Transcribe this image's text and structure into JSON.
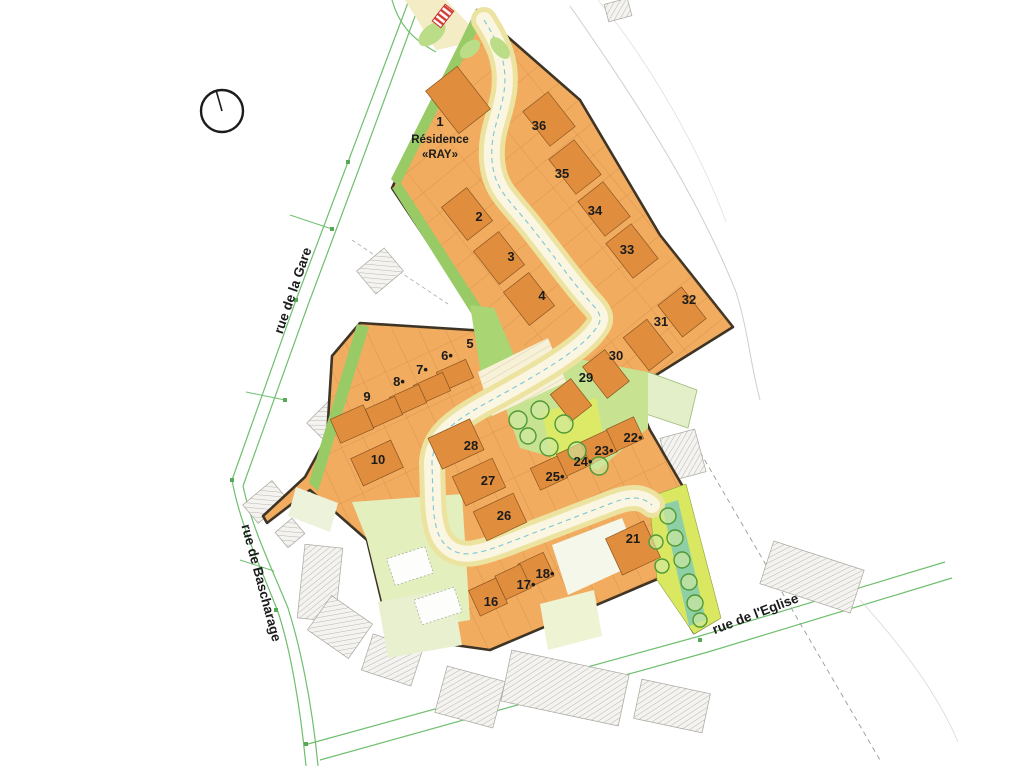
{
  "page": {
    "width": 1024,
    "height": 768,
    "background": "#ffffff",
    "title": "Plan de lotissement - Résidence «RAY»"
  },
  "plan": {
    "residence": {
      "lot_number": "1",
      "line1": "Résidence",
      "line2": "«RAY»",
      "x": 440,
      "y1": 126,
      "y2": 143,
      "y3": 158
    },
    "streets": [
      {
        "label": "rue de la Gare",
        "x": 297,
        "y": 292,
        "rot": -71
      },
      {
        "label": "rue de Bascharage",
        "x": 257,
        "y": 584,
        "rot": 75
      },
      {
        "label": "rue de l'Eglise",
        "x": 757,
        "y": 618,
        "rot": -21
      }
    ],
    "lots": [
      {
        "n": "2",
        "x": 479,
        "y": 221
      },
      {
        "n": "3",
        "x": 511,
        "y": 261
      },
      {
        "n": "4",
        "x": 542,
        "y": 300
      },
      {
        "n": "5",
        "x": 470,
        "y": 348
      },
      {
        "n": "6•",
        "x": 447,
        "y": 360
      },
      {
        "n": "7•",
        "x": 422,
        "y": 374
      },
      {
        "n": "8•",
        "x": 399,
        "y": 386
      },
      {
        "n": "9",
        "x": 367,
        "y": 401
      },
      {
        "n": "10",
        "x": 378,
        "y": 464
      },
      {
        "n": "16",
        "x": 491,
        "y": 606
      },
      {
        "n": "17•",
        "x": 526,
        "y": 589
      },
      {
        "n": "18•",
        "x": 545,
        "y": 578
      },
      {
        "n": "21",
        "x": 633,
        "y": 543
      },
      {
        "n": "22•",
        "x": 633,
        "y": 442
      },
      {
        "n": "23•",
        "x": 604,
        "y": 455
      },
      {
        "n": "24•",
        "x": 583,
        "y": 466
      },
      {
        "n": "25•",
        "x": 555,
        "y": 481
      },
      {
        "n": "26",
        "x": 504,
        "y": 520
      },
      {
        "n": "27",
        "x": 488,
        "y": 485
      },
      {
        "n": "28",
        "x": 471,
        "y": 450
      },
      {
        "n": "29",
        "x": 586,
        "y": 382
      },
      {
        "n": "30",
        "x": 616,
        "y": 360
      },
      {
        "n": "31",
        "x": 661,
        "y": 326
      },
      {
        "n": "32",
        "x": 689,
        "y": 304
      },
      {
        "n": "33",
        "x": 627,
        "y": 254
      },
      {
        "n": "34",
        "x": 595,
        "y": 215
      },
      {
        "n": "35",
        "x": 562,
        "y": 178
      },
      {
        "n": "36",
        "x": 539,
        "y": 130
      }
    ],
    "compass": {
      "cx": 222,
      "cy": 111,
      "r": 21,
      "nx": 216,
      "ny": 90
    },
    "north_marker": {
      "cx": 443,
      "cy": 16,
      "w": 21,
      "h": 11,
      "rot": -52
    },
    "zones": [
      {
        "name": "entry-road-outside",
        "pts": "405,0 446,0 484,40 436,50",
        "fill": "#F3ECC5"
      },
      {
        "name": "development-area",
        "pts": "477,10 580,100 660,235 733,327 632,390 650,430 686,492 719,618 694,633 660,578 490,650 390,636 367,540 310,490 267,523 263,516 305,477 327,437 332,356 360,323 487,331 392,188",
        "fill": "#F1AC60",
        "stroke": "#3E3425",
        "sw": 2.6
      },
      {
        "name": "lotgrid-upper",
        "pts": "477,10 580,100 660,235 733,327 632,390 487,331 392,188",
        "fill": "url(#gridU)"
      },
      {
        "name": "lotgrid-lower",
        "pts": "360,323 487,331 632,390 650,430 686,492 660,578 490,650 390,636 367,540 310,490 305,477 327,437 332,356",
        "fill": "url(#gridL)"
      },
      {
        "name": "green-strip-nw",
        "pts": "475,12 483,19 399,187 391,179",
        "fill": "#98CB66"
      },
      {
        "name": "green-strip-sw-upper",
        "pts": "392,188 401,183 493,325 483,332",
        "fill": "#98CB66"
      },
      {
        "name": "green-strip-band-left",
        "pts": "357,324 369,327 318,491 309,483",
        "fill": "#98CB66"
      },
      {
        "name": "green-wedge-road",
        "pts": "470,305 494,308 530,393 488,418",
        "fill": "#A9D573"
      },
      {
        "name": "garden-area",
        "pts": "352,502 462,494 470,620 390,634 367,540",
        "fill": "#E3EFBC"
      },
      {
        "name": "pale-lot-a",
        "pts": "378,602 452,588 462,645 388,658",
        "fill": "#E9F0CF"
      },
      {
        "name": "pale-lot-b",
        "pts": "540,604 594,590 602,636 548,650",
        "fill": "#EEF3D3"
      },
      {
        "name": "pale-lot-c",
        "pts": "296,487 338,503 330,532 288,516",
        "fill": "#EDF3DA"
      },
      {
        "name": "pale-lot-d",
        "pts": "552,545 622,518 640,562 568,595",
        "fill": "#F4F7EA"
      },
      {
        "name": "pale-green-ne",
        "pts": "648,372 697,390 688,428 640,412",
        "fill": "#E2EFC9",
        "stroke": "#9DBB77",
        "sw": 0.8
      },
      {
        "name": "central-green",
        "pts": "496,382 562,356 648,372 648,428 598,470 520,448",
        "fill": "#C7E392"
      },
      {
        "name": "green-patch",
        "pts": "542,412 596,398 606,450 552,462",
        "fill": "#DCEA67"
      },
      {
        "name": "plaza-base",
        "pts": "478,372 548,338 566,382 492,416",
        "fill": "#F7F1D8"
      },
      {
        "name": "plaza-stripes",
        "pts": "478,372 548,338 566,382 492,416",
        "fill": "url(#parkstripe)"
      },
      {
        "name": "se-strip-outer",
        "pts": "649,497 686,484 721,618 694,634 657,580",
        "fill": "#D9E860",
        "stroke": "#8CA23F",
        "sw": 0.6
      },
      {
        "name": "se-strip-stream",
        "pts": "662,505 678,500 706,620 689,626",
        "fill": "#8FCFA6"
      }
    ],
    "survey_paths": [
      {
        "name": "street-line-gare-a",
        "d": "M409,0 L348,162 L296,300 L232,480",
        "stroke": "#6FBF6F",
        "w": 1.2
      },
      {
        "name": "street-line-gare-b",
        "d": "M421,0 L360,166 L308,305 L243,486",
        "stroke": "#6FBF6F",
        "w": 1.2
      },
      {
        "name": "street-line-top-bend",
        "d": "M392,0 C398,22 410,38 436,52",
        "stroke": "#6FBF6F",
        "w": 1.2
      },
      {
        "name": "street-line-bascharage-a",
        "d": "M232,480 C240,525 260,565 278,612 C290,648 300,704 306,766",
        "stroke": "#6FBF6F",
        "w": 1.2
      },
      {
        "name": "street-line-bascharage-b",
        "d": "M243,486 C252,528 270,564 288,608 C300,646 312,702 318,766",
        "stroke": "#6FBF6F",
        "w": 1.2
      },
      {
        "name": "street-line-eglise-a",
        "d": "M308,744 L700,636 L945,562",
        "stroke": "#6FBF6F",
        "w": 1.2
      },
      {
        "name": "street-line-eglise-b",
        "d": "M320,760 L708,652 L952,578",
        "stroke": "#6FBF6F",
        "w": 1.2
      },
      {
        "name": "contour-line-1",
        "d": "M570,6 C620,78 692,182 736,292 C748,330 750,362 760,400",
        "stroke": "#C8C6C0",
        "w": 1,
        "op": 0.85
      },
      {
        "name": "contour-line-2",
        "d": "M598,0 C648,60 700,150 726,222",
        "stroke": "#D5D3CD",
        "w": 0.8,
        "op": 0.7
      },
      {
        "name": "contour-line-3",
        "d": "M860,600 C900,644 938,694 958,742",
        "stroke": "#CFCDC7",
        "w": 0.8,
        "op": 0.8
      },
      {
        "name": "dashed-line-se",
        "d": "M700,452 L880,760",
        "stroke": "#9B9B93",
        "w": 0.9,
        "dash": "5,4"
      },
      {
        "name": "dashed-line-notch",
        "d": "M352,240 L448,304",
        "stroke": "#ABABA3",
        "w": 0.8,
        "dash": "4,3"
      },
      {
        "name": "survey-branch-1",
        "d": "M290,215 L332,229",
        "stroke": "#6FBF6F",
        "w": 1
      },
      {
        "name": "survey-branch-2",
        "d": "M246,392 L285,400",
        "stroke": "#6FBF6F",
        "w": 1
      },
      {
        "name": "survey-branch-3",
        "d": "M240,560 L274,571",
        "stroke": "#6FBF6F",
        "w": 1
      }
    ],
    "road": {
      "d": "M484,20 C498,42 508,62 504,92 C500,118 490,132 492,160 C494,186 505,196 522,216 C545,243 570,280 592,304 C602,315 603,320 594,331 C578,352 532,378 488,402 C452,422 434,436 432,462 L433,500 C434,526 438,542 452,550 C464,557 478,554 505,544 L612,503 C630,496 642,496 652,505",
      "edge_color": "#EDE3A0",
      "edge_w": 26,
      "surface_color": "#FAF6E2",
      "surface_w": 16,
      "center_color": "#7CC6D6",
      "center_w": 1.1,
      "center_dash": "5,4"
    },
    "hatched_buildings": [
      {
        "cx": 380,
        "cy": 271,
        "w": 30,
        "h": 36,
        "rot": 50
      },
      {
        "cx": 618,
        "cy": 10,
        "w": 24,
        "h": 18,
        "rot": -15
      },
      {
        "cx": 340,
        "cy": 428,
        "w": 54,
        "h": 40,
        "rot": 45
      },
      {
        "cx": 265,
        "cy": 502,
        "w": 24,
        "h": 38,
        "rot": 50
      },
      {
        "cx": 290,
        "cy": 533,
        "w": 20,
        "h": 22,
        "rot": 50
      },
      {
        "cx": 320,
        "cy": 583,
        "w": 38,
        "h": 74,
        "rot": 6
      },
      {
        "cx": 340,
        "cy": 627,
        "w": 50,
        "h": 42,
        "rot": 35
      },
      {
        "cx": 392,
        "cy": 660,
        "w": 52,
        "h": 38,
        "rot": 18
      },
      {
        "cx": 470,
        "cy": 697,
        "w": 60,
        "h": 48,
        "rot": 15
      },
      {
        "cx": 565,
        "cy": 688,
        "w": 120,
        "h": 52,
        "rot": 12
      },
      {
        "cx": 672,
        "cy": 706,
        "w": 70,
        "h": 40,
        "rot": 12
      },
      {
        "cx": 812,
        "cy": 577,
        "w": 95,
        "h": 45,
        "rot": 18
      },
      {
        "cx": 683,
        "cy": 455,
        "w": 36,
        "h": 44,
        "rot": -15
      }
    ],
    "buildings": [
      {
        "cx": 458,
        "cy": 100,
        "w": 54,
        "h": 40,
        "rot": 52
      },
      {
        "cx": 549,
        "cy": 119,
        "w": 44,
        "h": 32,
        "rot": 52
      },
      {
        "cx": 575,
        "cy": 167,
        "w": 44,
        "h": 32,
        "rot": 52
      },
      {
        "cx": 604,
        "cy": 209,
        "w": 44,
        "h": 32,
        "rot": 52
      },
      {
        "cx": 632,
        "cy": 251,
        "w": 44,
        "h": 32,
        "rot": 52
      },
      {
        "cx": 467,
        "cy": 214,
        "w": 42,
        "h": 32,
        "rot": 52
      },
      {
        "cx": 499,
        "cy": 258,
        "w": 42,
        "h": 32,
        "rot": 52
      },
      {
        "cx": 529,
        "cy": 299,
        "w": 42,
        "h": 32,
        "rot": 52
      },
      {
        "cx": 682,
        "cy": 312,
        "w": 40,
        "h": 30,
        "rot": 52
      },
      {
        "cx": 648,
        "cy": 345,
        "w": 42,
        "h": 30,
        "rot": 52
      },
      {
        "cx": 606,
        "cy": 374,
        "w": 40,
        "h": 28,
        "rot": 52
      },
      {
        "cx": 571,
        "cy": 400,
        "w": 34,
        "h": 26,
        "rot": 52
      },
      {
        "cx": 455,
        "cy": 375,
        "w": 20,
        "h": 32,
        "rot": 66
      },
      {
        "cx": 432,
        "cy": 388,
        "w": 20,
        "h": 32,
        "rot": 66
      },
      {
        "cx": 408,
        "cy": 400,
        "w": 20,
        "h": 32,
        "rot": 66
      },
      {
        "cx": 384,
        "cy": 412,
        "w": 20,
        "h": 32,
        "rot": 66
      },
      {
        "cx": 352,
        "cy": 424,
        "w": 26,
        "h": 36,
        "rot": 66
      },
      {
        "cx": 377,
        "cy": 463,
        "w": 44,
        "h": 30,
        "rot": -25
      },
      {
        "cx": 456,
        "cy": 444,
        "w": 46,
        "h": 34,
        "rot": -25
      },
      {
        "cx": 479,
        "cy": 482,
        "w": 44,
        "h": 32,
        "rot": -25
      },
      {
        "cx": 500,
        "cy": 517,
        "w": 44,
        "h": 32,
        "rot": -25
      },
      {
        "cx": 549,
        "cy": 473,
        "w": 30,
        "h": 24,
        "rot": -25
      },
      {
        "cx": 575,
        "cy": 459,
        "w": 30,
        "h": 24,
        "rot": -25
      },
      {
        "cx": 599,
        "cy": 447,
        "w": 30,
        "h": 24,
        "rot": -25
      },
      {
        "cx": 625,
        "cy": 434,
        "w": 30,
        "h": 24,
        "rot": -25
      },
      {
        "cx": 633,
        "cy": 548,
        "w": 42,
        "h": 40,
        "rot": -25
      },
      {
        "cx": 536,
        "cy": 570,
        "w": 28,
        "h": 26,
        "rot": -25
      },
      {
        "cx": 513,
        "cy": 582,
        "w": 28,
        "h": 26,
        "rot": -25
      },
      {
        "cx": 488,
        "cy": 597,
        "w": 30,
        "h": 28,
        "rot": -25
      }
    ],
    "garden_buildings": [
      {
        "cx": 410,
        "cy": 566,
        "w": 40,
        "h": 28,
        "rot": -18
      },
      {
        "cx": 438,
        "cy": 606,
        "w": 42,
        "h": 26,
        "rot": -18
      }
    ],
    "trees": [
      {
        "cx": 518,
        "cy": 420,
        "r": 9
      },
      {
        "cx": 540,
        "cy": 410,
        "r": 9
      },
      {
        "cx": 564,
        "cy": 424,
        "r": 9
      },
      {
        "cx": 549,
        "cy": 447,
        "r": 9
      },
      {
        "cx": 577,
        "cy": 451,
        "r": 9
      },
      {
        "cx": 599,
        "cy": 466,
        "r": 9
      },
      {
        "cx": 528,
        "cy": 436,
        "r": 8
      },
      {
        "cx": 668,
        "cy": 516,
        "r": 8
      },
      {
        "cx": 675,
        "cy": 538,
        "r": 8
      },
      {
        "cx": 682,
        "cy": 560,
        "r": 8
      },
      {
        "cx": 689,
        "cy": 582,
        "r": 8
      },
      {
        "cx": 695,
        "cy": 603,
        "r": 8
      },
      {
        "cx": 700,
        "cy": 620,
        "r": 7
      },
      {
        "cx": 656,
        "cy": 542,
        "r": 7
      },
      {
        "cx": 662,
        "cy": 566,
        "r": 7
      }
    ],
    "green_blobs": [
      {
        "cx": 432,
        "cy": 34,
        "rx": 16,
        "ry": 9,
        "rot": -40
      },
      {
        "cx": 470,
        "cy": 49,
        "rx": 12,
        "ry": 7,
        "rot": -40
      },
      {
        "cx": 500,
        "cy": 48,
        "rx": 13,
        "ry": 7,
        "rot": 50
      }
    ],
    "line_markers": [
      {
        "x": 348,
        "y": 162
      },
      {
        "x": 296,
        "y": 300
      },
      {
        "x": 232,
        "y": 480
      },
      {
        "x": 276,
        "y": 610
      },
      {
        "x": 306,
        "y": 744
      },
      {
        "x": 700,
        "y": 640
      },
      {
        "x": 850,
        "y": 588
      },
      {
        "x": 332,
        "y": 229
      },
      {
        "x": 285,
        "y": 400
      }
    ],
    "style": {
      "building_fill": "#E08E3E",
      "building_stroke": "#8A5420",
      "tree_fill": "#CFE8A0",
      "tree_stroke": "#4F9937",
      "label_color": "#1b1b1b",
      "marker_green": "#57A957"
    }
  }
}
